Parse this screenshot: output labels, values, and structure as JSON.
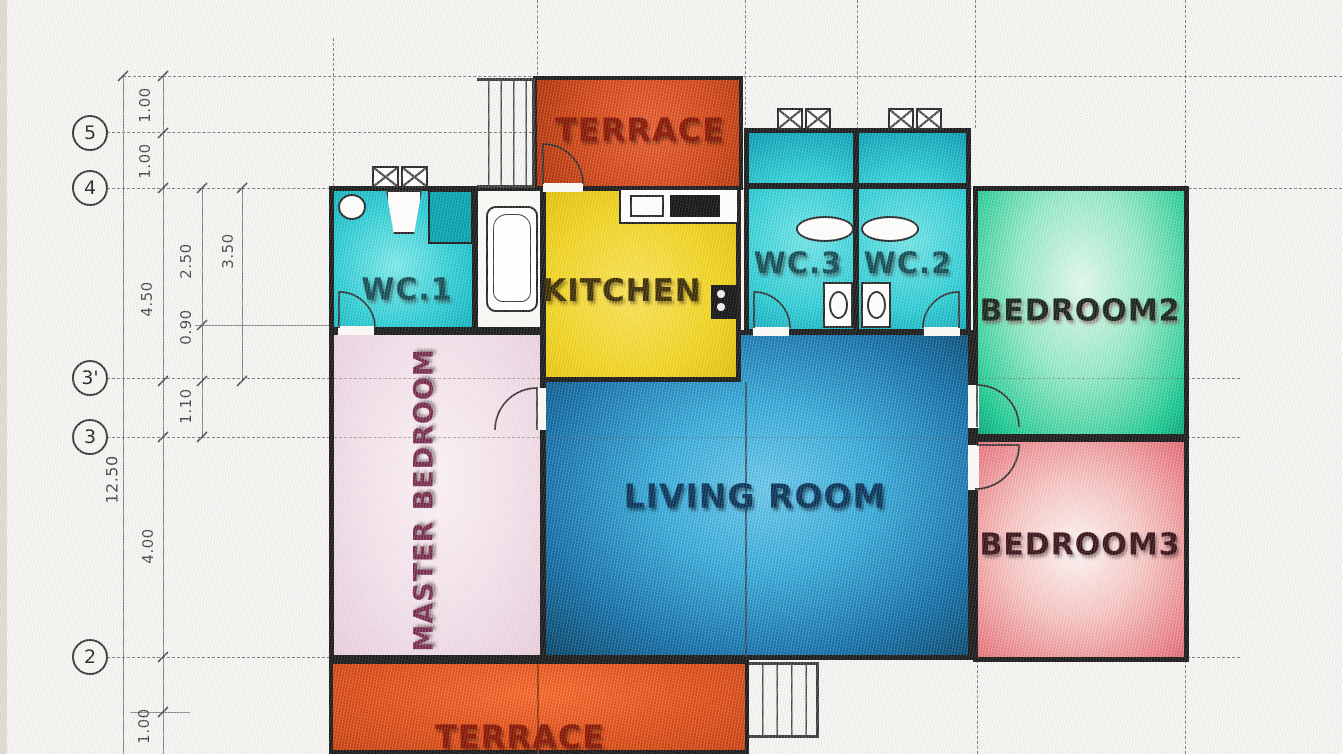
{
  "rooms": {
    "terrace_top": {
      "label": "TERRACE"
    },
    "wc1": {
      "label": "WC.1"
    },
    "kitchen": {
      "label": "KITCHEN"
    },
    "wc3": {
      "label": "WC.3"
    },
    "wc2": {
      "label": "WC.2"
    },
    "bedroom2": {
      "label": "BEDROOM2"
    },
    "master_bedroom": {
      "label": "MASTER BEDROOM"
    },
    "living_room": {
      "label": "LIVING ROOM"
    },
    "bedroom3": {
      "label": "BEDROOM3"
    },
    "terrace_bottom": {
      "label": "TERRACE"
    }
  },
  "grid_bubbles": {
    "b5": "5",
    "b4": "4",
    "b3p": "3'",
    "b3": "3",
    "b2": "2"
  },
  "dimensions": {
    "top_a": "1.00",
    "top_b": "1.00",
    "h_450": "4.50",
    "h_350": "3.50",
    "h_250": "2.50",
    "h_090": "0.90",
    "h_110": "1.10",
    "h_1250": "12.50",
    "h_400": "4.00",
    "bottom_a": "1.00"
  },
  "colors": {
    "paper": "#f0efec",
    "wall": "#181818",
    "terrace_top": "#c73c16",
    "terrace_bottom": "#d84418",
    "wc_cyan": "#27c4cc",
    "wc_dark": "#0d96a6",
    "kitchen_yellow": "#eccc1d",
    "bedroom2_green": "#19c086",
    "bedroom3_pink": "#e4787e",
    "master_pink": "#eedae4",
    "living_blue": "#2f9fd0",
    "label_red": "#7c150b",
    "label_navy": "#0e2c4e",
    "label_teal": "#14444c",
    "label_maroon": "#6d2744"
  }
}
